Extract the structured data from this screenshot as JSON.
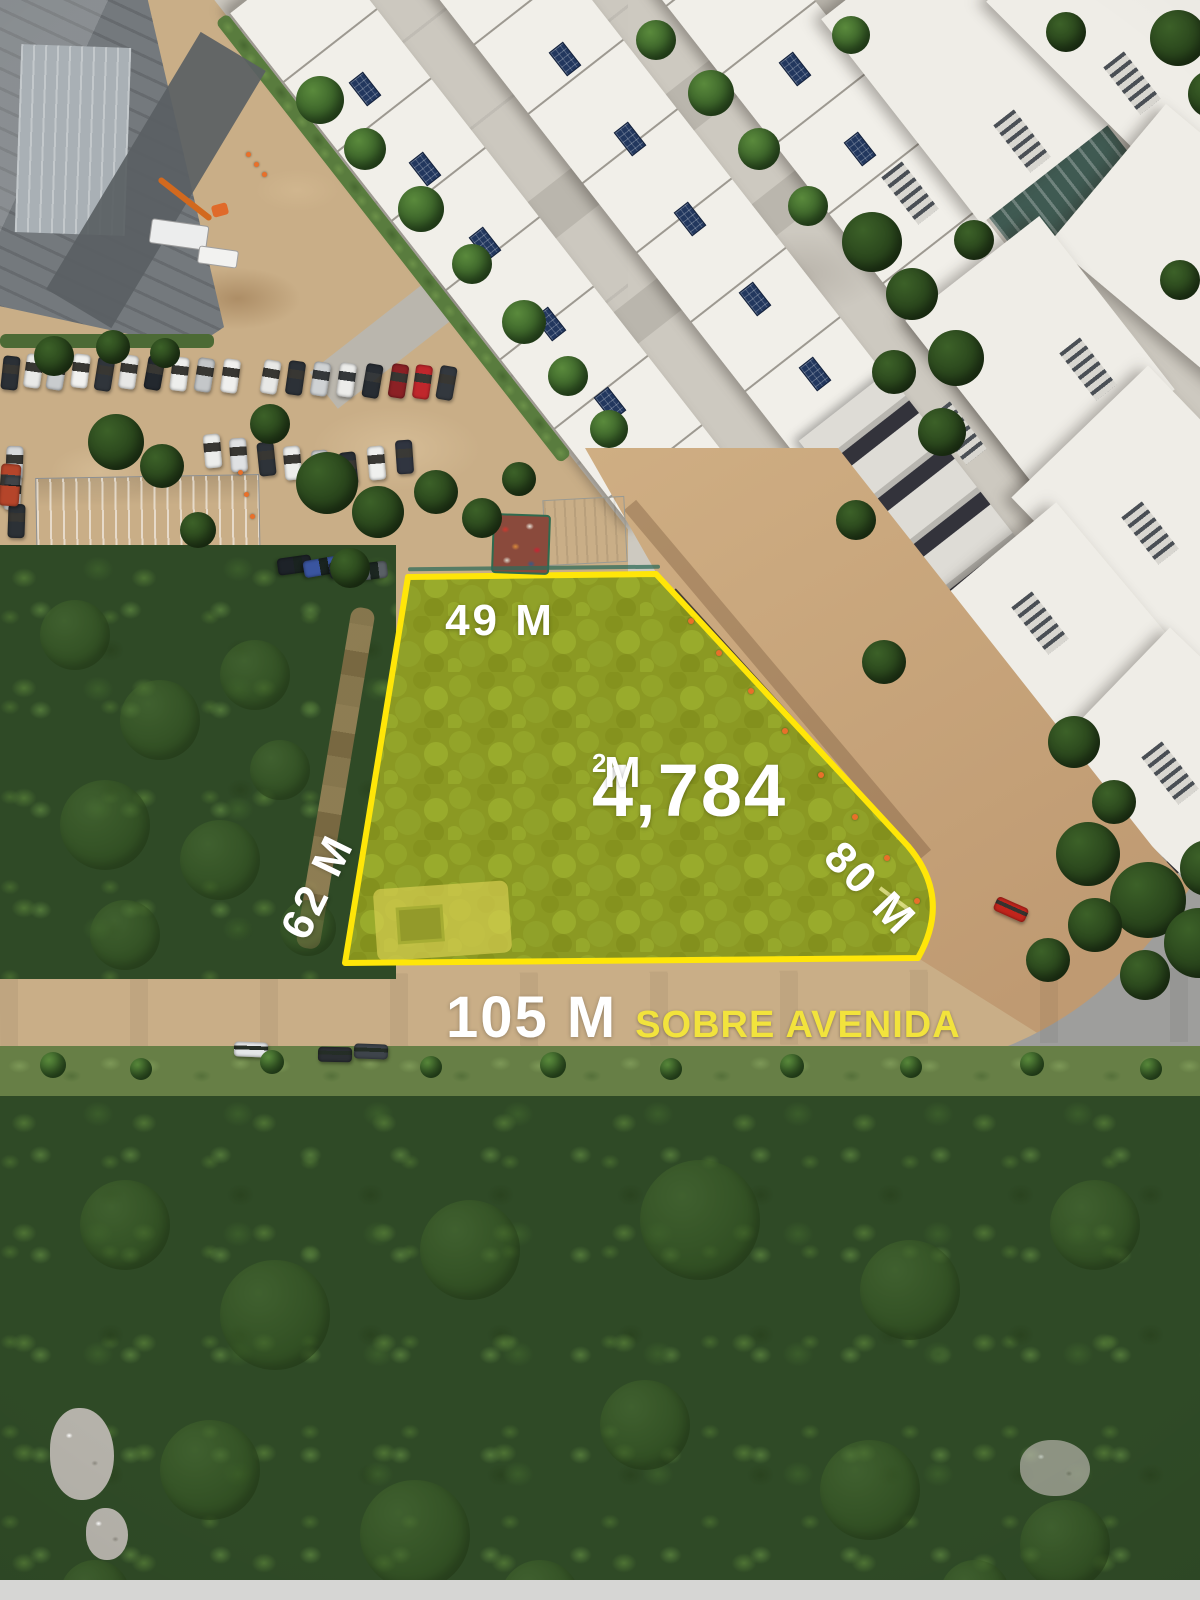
{
  "annotations": {
    "top_edge_label": "49 M",
    "left_edge_label": "62 M",
    "right_edge_label": "80 M",
    "area_value": "4,784",
    "area_unit": "M",
    "area_exponent": "2",
    "frontage_value": "105 M",
    "frontage_caption": "SOBRE AVENIDA"
  },
  "colors": {
    "plot_outline": "#FFE608",
    "plot_fill": "rgba(234,228,40,0.42)",
    "label_text": "#FFFFFF",
    "frontage_caption_color": "#F2E33C",
    "pool": "#38B2CF",
    "road": "#9E9E9C",
    "dirt": "#C9AE87",
    "forest": "#2F4A26"
  }
}
